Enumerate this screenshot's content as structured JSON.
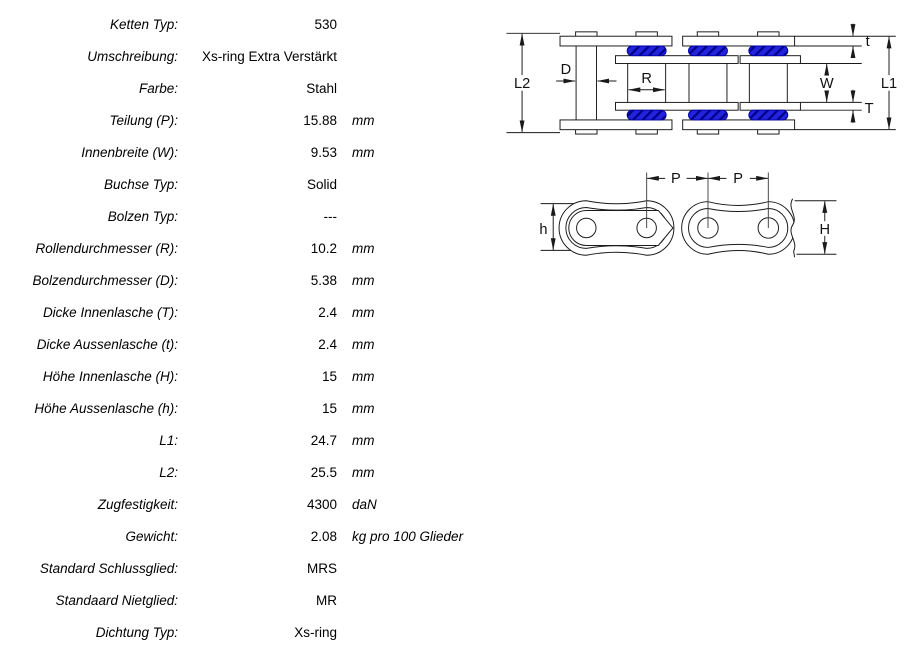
{
  "spec_table": {
    "rows": [
      {
        "label": "Ketten Typ:",
        "value": "530",
        "unit": ""
      },
      {
        "label": "Umschreibung:",
        "value": "Xs-ring Extra Verstärkt",
        "unit": ""
      },
      {
        "label": "Farbe:",
        "value": "Stahl",
        "unit": ""
      },
      {
        "label": "Teilung (P):",
        "value": "15.88",
        "unit": "mm"
      },
      {
        "label": "Innenbreite (W):",
        "value": "9.53",
        "unit": "mm"
      },
      {
        "label": "Buchse Typ:",
        "value": "Solid",
        "unit": ""
      },
      {
        "label": "Bolzen Typ:",
        "value": "---",
        "unit": ""
      },
      {
        "label": "Rollendurchmesser (R):",
        "value": "10.2",
        "unit": "mm"
      },
      {
        "label": "Bolzendurchmesser (D):",
        "value": "5.38",
        "unit": "mm"
      },
      {
        "label": "Dicke Innenlasche (T):",
        "value": "2.4",
        "unit": "mm"
      },
      {
        "label": "Dicke Aussenlasche (t):",
        "value": "2.4",
        "unit": "mm"
      },
      {
        "label": "Höhe Innenlasche (H):",
        "value": "15",
        "unit": "mm"
      },
      {
        "label": "Höhe Aussenlasche (h):",
        "value": "15",
        "unit": "mm"
      },
      {
        "label": "L1:",
        "value": "24.7",
        "unit": "mm"
      },
      {
        "label": "L2:",
        "value": "25.5",
        "unit": "mm"
      },
      {
        "label": "Zugfestigkeit:",
        "value": "4300",
        "unit": "daN"
      },
      {
        "label": "Gewicht:",
        "value": "2.08",
        "unit": "kg pro 100 Glieder"
      },
      {
        "label": "Standard Schlussglied:",
        "value": "MRS",
        "unit": ""
      },
      {
        "label": "Standaard Nietglied:",
        "value": "MR",
        "unit": ""
      },
      {
        "label": "Dichtung Typ:",
        "value": "Xs-ring",
        "unit": ""
      }
    ]
  },
  "diagram": {
    "labels": {
      "l2": "L2",
      "d": "D",
      "r": "R",
      "w": "W",
      "l1": "L1",
      "t_outer": "t",
      "t_inner": "T",
      "p_left": "P",
      "p_right": "P",
      "h_outer": "h",
      "h_inner": "H"
    },
    "colors": {
      "seal_fill": "#2323dd",
      "seal_hatch": "#000088",
      "line": "#1a1a1a"
    }
  }
}
